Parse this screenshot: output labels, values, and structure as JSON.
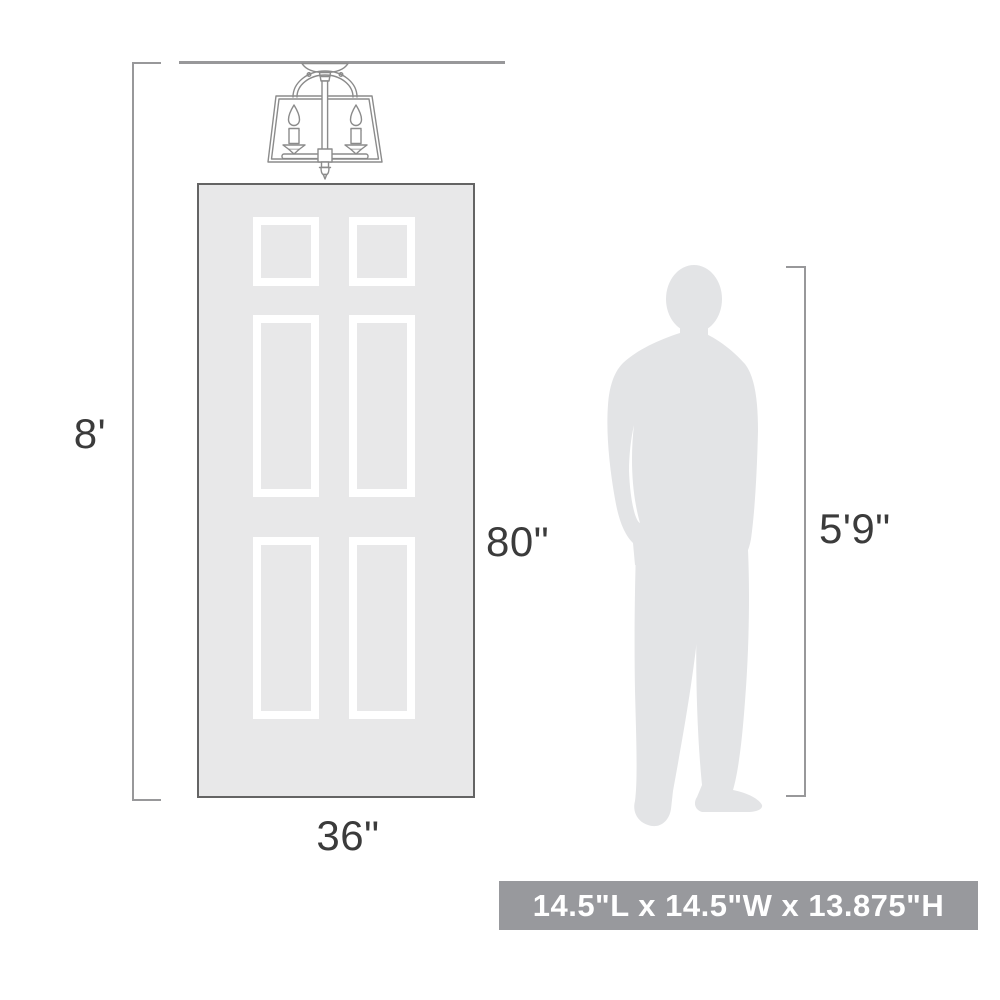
{
  "diagram": {
    "kind": "product-scale-comparison",
    "labels": {
      "ceiling_height": "8'",
      "door_height": "80\"",
      "door_width": "36\"",
      "person_height": "5'9\"",
      "product_size": "14.5\"L x 14.5\"W x 13.875\"H"
    },
    "icons": {
      "fixture": "semi-flush-cage-ceiling-light-line-drawing",
      "door": "six-panel-door",
      "person": "standing-man-silhouette"
    },
    "colors": {
      "background": "#ffffff",
      "dimension_lines": "#98989a",
      "label_text": "#3b3b3b",
      "door_fill": "#e8e8e9",
      "door_border": "#646464",
      "panel_frame": "#ffffff",
      "silhouette_fill": "#e3e4e6",
      "fixture_lines": "#8b8b8b",
      "badge_background": "#98999d",
      "badge_text": "#ffffff"
    }
  }
}
